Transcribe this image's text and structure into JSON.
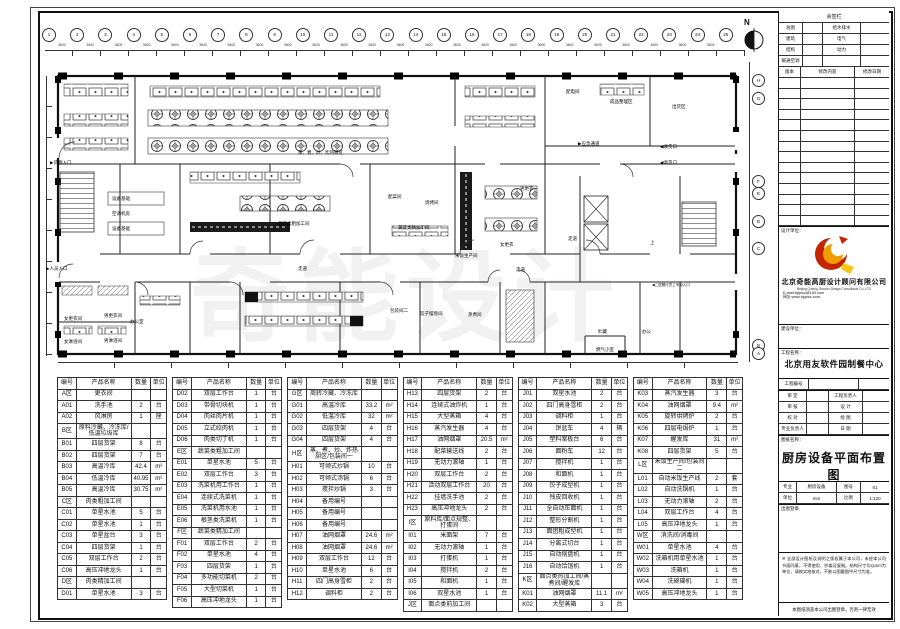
{
  "sheet": {
    "watermark": "奇能设计",
    "compass_label": "N"
  },
  "plan": {
    "top_axis": [
      "1",
      "2",
      "3",
      "4",
      "5",
      "6",
      "7",
      "8",
      "9",
      "10",
      "11",
      "12",
      "13",
      "14",
      "15",
      "16",
      "17",
      "18",
      "19",
      "20",
      "21",
      "22",
      "23",
      "24",
      "25"
    ],
    "bay_dim": "3600",
    "side_axis": [
      "H",
      "G",
      "F",
      "E",
      "D",
      "C",
      "B",
      "A"
    ],
    "labels": [
      "▶货物入口",
      "▶人员入口",
      "设备基础",
      "空调机房",
      "设备基础",
      "蒸、煮、炒、炸热厨区",
      "蔬菜类粗加工间",
      "蔬菜类精加工间",
      "配菜间",
      "烧烤间",
      "米饭生产间",
      "配电间",
      "成品整理区",
      "出货区",
      "▶应急通道",
      "◀收货口",
      "◀退货口",
      "男更衣",
      "女更衣",
      "走道",
      "走道",
      "上",
      "贮藏",
      "办公",
      "燃气小室",
      "办公室",
      "女更衣间",
      "男更衣间",
      "女淋浴间",
      "男淋浴间",
      "包装间二",
      "饺子摆盘间",
      "蒸煮间",
      "◀二层餐厅员工专用入口",
      "走道"
    ]
  },
  "equipment_tables": {
    "headers": [
      "编号",
      "产品名称",
      "数量",
      "单位"
    ],
    "tables": [
      {
        "rows": [
          [
            "A区",
            "更衣间",
            "",
            ""
          ],
          [
            "A01",
            "洗手池",
            "2",
            "台"
          ],
          [
            "A02",
            "风淋房",
            "1",
            "座"
          ],
          [
            "B区",
            "原料冷藏、冷冻库/低温垃圾库",
            "",
            ""
          ],
          [
            "B01",
            "四层货架",
            "8",
            "台"
          ],
          [
            "B02",
            "四层货架",
            "7",
            "台"
          ],
          [
            "B03",
            "高温冷库",
            "42.4",
            "m²"
          ],
          [
            "B04",
            "低温冷库",
            "40.95",
            "m²"
          ],
          [
            "B05",
            "高温冷库",
            "30.75",
            "m²"
          ],
          [
            "C区",
            "肉类粗加工间",
            "",
            ""
          ],
          [
            "C01",
            "单星水池",
            "5",
            "台"
          ],
          [
            "C02",
            "单星水池",
            "1",
            "台"
          ],
          [
            "C03",
            "单星盆台",
            "3",
            "台"
          ],
          [
            "C04",
            "四层货架",
            "1",
            "台"
          ],
          [
            "C05",
            "双层工作台",
            "2",
            "台"
          ],
          [
            "C06",
            "高压冲地龙头",
            "1",
            "台"
          ],
          [
            "D区",
            "肉类精加工间",
            "",
            ""
          ],
          [
            "D01",
            "单星水池",
            "3",
            "台"
          ]
        ]
      },
      {
        "rows": [
          [
            "D02",
            "双层工作台",
            "1",
            "台"
          ],
          [
            "D03",
            "带骨切块机",
            "1",
            "台"
          ],
          [
            "D04",
            "肉丝肉片机",
            "1",
            "台"
          ],
          [
            "D05",
            "立式绞肉机",
            "1",
            "台"
          ],
          [
            "D06",
            "肉类切丁机",
            "1",
            "台"
          ],
          [
            "E区",
            "蔬菜类粗加工间",
            "",
            ""
          ],
          [
            "E01",
            "单星水池",
            "5",
            "台"
          ],
          [
            "E02",
            "双层工作台",
            "3",
            "台"
          ],
          [
            "E03",
            "洗菜机用工作台",
            "1",
            "台"
          ],
          [
            "E04",
            "连续式洗菜机",
            "1",
            "台"
          ],
          [
            "E05",
            "洗菜机用水池",
            "1",
            "台"
          ],
          [
            "E06",
            "根茎类洗菜机",
            "1",
            "台"
          ],
          [
            "F区",
            "蔬菜类精加工间",
            "",
            ""
          ],
          [
            "F01",
            "双层工作台",
            "2",
            "台"
          ],
          [
            "F02",
            "单星水池",
            "4",
            "台"
          ],
          [
            "F03",
            "四层货架",
            "1",
            "台"
          ],
          [
            "F04",
            "多功能切菜机",
            "2",
            "台"
          ],
          [
            "F05",
            "大型切菜机",
            "1",
            "台"
          ],
          [
            "F06",
            "高压冲地龙头",
            "1",
            "台"
          ]
        ]
      },
      {
        "rows": [
          [
            "G区",
            "周转冷藏、冷冻库",
            "",
            ""
          ],
          [
            "G01",
            "高温冷库",
            "33.2",
            "m²"
          ],
          [
            "G02",
            "低温冷库",
            "32",
            "m²"
          ],
          [
            "G03",
            "四层货架",
            "4",
            "台"
          ],
          [
            "G04",
            "四层货架",
            "4",
            "台"
          ],
          [
            "H区",
            "蒸、煮、炒、炸热厨区/包装间一",
            "",
            ""
          ],
          [
            "H01",
            "可倾式炒锅",
            "10",
            "台"
          ],
          [
            "H02",
            "可倾式汤锅",
            "6",
            "台"
          ],
          [
            "H03",
            "搅拌炒锅",
            "3",
            "台"
          ],
          [
            "H04",
            "备用编号",
            "",
            ""
          ],
          [
            "H05",
            "备用编号",
            "",
            ""
          ],
          [
            "H06",
            "备用编号",
            "",
            ""
          ],
          [
            "H07",
            "油网烟罩",
            "24.6",
            "m²"
          ],
          [
            "H08",
            "油网烟罩",
            "24.6",
            "m²"
          ],
          [
            "H09",
            "双层工作台",
            "12",
            "台"
          ],
          [
            "H10",
            "单星水池",
            "6",
            "台"
          ],
          [
            "H11",
            "四门高身雪柜",
            "2",
            "台"
          ],
          [
            "H12",
            "调料柜",
            "2",
            "台"
          ]
        ]
      },
      {
        "rows": [
          [
            "H13",
            "四层货架",
            "2",
            "台"
          ],
          [
            "H14",
            "连续式油炸机",
            "1",
            "台"
          ],
          [
            "H15",
            "大型蒸箱",
            "4",
            "台"
          ],
          [
            "H16",
            "蒸汽发生器",
            "4",
            "台"
          ],
          [
            "H17",
            "油网烟罩",
            "20.5",
            "m²"
          ],
          [
            "H18",
            "配菜输送线",
            "2",
            "台"
          ],
          [
            "H19",
            "无动力滚轴",
            "1",
            "台"
          ],
          [
            "H20",
            "双层工作台",
            "2",
            "台"
          ],
          [
            "H21",
            "活动双层工作台",
            "20",
            "台"
          ],
          [
            "H22",
            "挂墙洗手池",
            "2",
            "台"
          ],
          [
            "H23",
            "高压冲地龙头",
            "2",
            "台"
          ],
          [
            "I区",
            "原料库/面点规整、打蛋间",
            "",
            ""
          ],
          [
            "I01",
            "米面架",
            "7",
            "台"
          ],
          [
            "I02",
            "无动力滚轴",
            "1",
            "台"
          ],
          [
            "I03",
            "打蛋机",
            "1",
            "台"
          ],
          [
            "I04",
            "搅拌机",
            "2",
            "台"
          ],
          [
            "I05",
            "和面机",
            "1",
            "台"
          ],
          [
            "I06",
            "双星水池",
            "1",
            "台"
          ],
          [
            "J区",
            "面点类前加工间",
            "",
            ""
          ]
        ]
      },
      {
        "rows": [
          [
            "J01",
            "双星水池",
            "2",
            "台"
          ],
          [
            "J02",
            "四门高身雪柜",
            "2",
            "台"
          ],
          [
            "J03",
            "调料柜",
            "1",
            "台"
          ],
          [
            "J04",
            "饼盆车",
            "4",
            "辆"
          ],
          [
            "J05",
            "塑料案板台",
            "6",
            "台"
          ],
          [
            "J06",
            "面粉车",
            "12",
            "台"
          ],
          [
            "J07",
            "搅拌机",
            "1",
            "台"
          ],
          [
            "J08",
            "和面机",
            "1",
            "台"
          ],
          [
            "J09",
            "饺子成型机",
            "1",
            "台"
          ],
          [
            "J10",
            "残皮回收机",
            "1",
            "台"
          ],
          [
            "J11",
            "全自动压面机",
            "1",
            "台"
          ],
          [
            "J12",
            "整形分割机",
            "1",
            "台"
          ],
          [
            "J13",
            "面团粗成型机",
            "1",
            "台"
          ],
          [
            "J14",
            "分离式切台",
            "1",
            "台"
          ],
          [
            "J15",
            "自动摆盘机",
            "1",
            "台"
          ],
          [
            "J16",
            "自动饸饹机",
            "1",
            "台"
          ],
          [
            "K区",
            "面点类热加工间/蒸煮间/醒发库",
            "",
            ""
          ],
          [
            "K01",
            "油网烟罩",
            "11.1",
            "m²"
          ],
          [
            "K02",
            "大型蒸箱",
            "3",
            "台"
          ]
        ]
      },
      {
        "rows": [
          [
            "K03",
            "蒸汽发生器",
            "3",
            "台"
          ],
          [
            "K04",
            "油网烟罩",
            "9.4",
            "m²"
          ],
          [
            "K05",
            "旋转烘烤炉",
            "2",
            "台"
          ],
          [
            "K06",
            "四层电焗炉",
            "1",
            "台"
          ],
          [
            "K07",
            "醒发库",
            "31",
            "m²"
          ],
          [
            "K08",
            "四层货架",
            "5",
            "台"
          ],
          [
            "L区",
            "米饭生产间/包装间二",
            "",
            ""
          ],
          [
            "L01",
            "自动米饭生产线",
            "2",
            "套"
          ],
          [
            "L02",
            "自动洗锅机",
            "1",
            "台"
          ],
          [
            "L03",
            "无动力滚轴",
            "2",
            "台"
          ],
          [
            "L04",
            "双层工作台",
            "4",
            "台"
          ],
          [
            "L05",
            "高压冲地龙头",
            "1",
            "台"
          ],
          [
            "W区",
            "消洗间/消毒间",
            "",
            ""
          ],
          [
            "W01",
            "单星水池",
            "4",
            "台"
          ],
          [
            "W02",
            "洗箱机用单星水池",
            "1",
            "台"
          ],
          [
            "W03",
            "洗箱机",
            "1",
            "台"
          ],
          [
            "W04",
            "洗碗碟机",
            "1",
            "台"
          ],
          [
            "W05",
            "高压冲地龙头",
            "1",
            "台"
          ]
        ]
      }
    ]
  },
  "titleblock": {
    "sign_header": "会签栏",
    "sign_rows": [
      [
        "总图",
        "",
        "给水排水",
        ""
      ],
      [
        "建筑",
        "",
        "电气",
        ""
      ],
      [
        "结构",
        "",
        "动力",
        ""
      ],
      [
        "暖通空调",
        "",
        "",
        ""
      ]
    ],
    "rev_header": [
      "版本",
      "修改内容",
      "修改日期"
    ],
    "rev_empty_count": 14,
    "design_unit_label": "设计单位：",
    "company_cn": "北京奇能高厨设计顾问有限公司",
    "company_en": "Beijing Qineng Gaochu Design Consultants Co.,LTD",
    "email": "E-mail:bjqnsc@163.com",
    "website": "网址:www.bjqnsc.com",
    "client_label": "建设单位：",
    "project_label": "工程名称：",
    "project_name": "北京用友软件园制餐中心",
    "project_no_row": [
      "工程编号",
      "",
      ""
    ],
    "field_rows": [
      [
        "审 定",
        "",
        "工程负责人",
        ""
      ],
      [
        "审 核",
        "",
        "设 计",
        ""
      ],
      [
        "校 对",
        "",
        "绘 图",
        ""
      ],
      [
        "专业负责人",
        "",
        "日 期",
        ""
      ]
    ],
    "drawing_label": "图纸名称：",
    "drawing_title": "厨房设备平面布置图",
    "meta_rows": [
      [
        "专业",
        "厨房设备",
        "图号",
        "01"
      ],
      [
        "单位",
        "mm",
        "比例",
        "1:120"
      ]
    ],
    "stamp_label": "出图登章",
    "note1": "※ 全部设计图纸及说明之版权属于本公司，未经本公司书面同意，不得使用、抄袭及复制。结构尺寸均以mm为单位，请按实地核对，不能以图量图中尺寸为准。",
    "note2": "本图纸须盖本公司出图登章，否则一律无效"
  }
}
